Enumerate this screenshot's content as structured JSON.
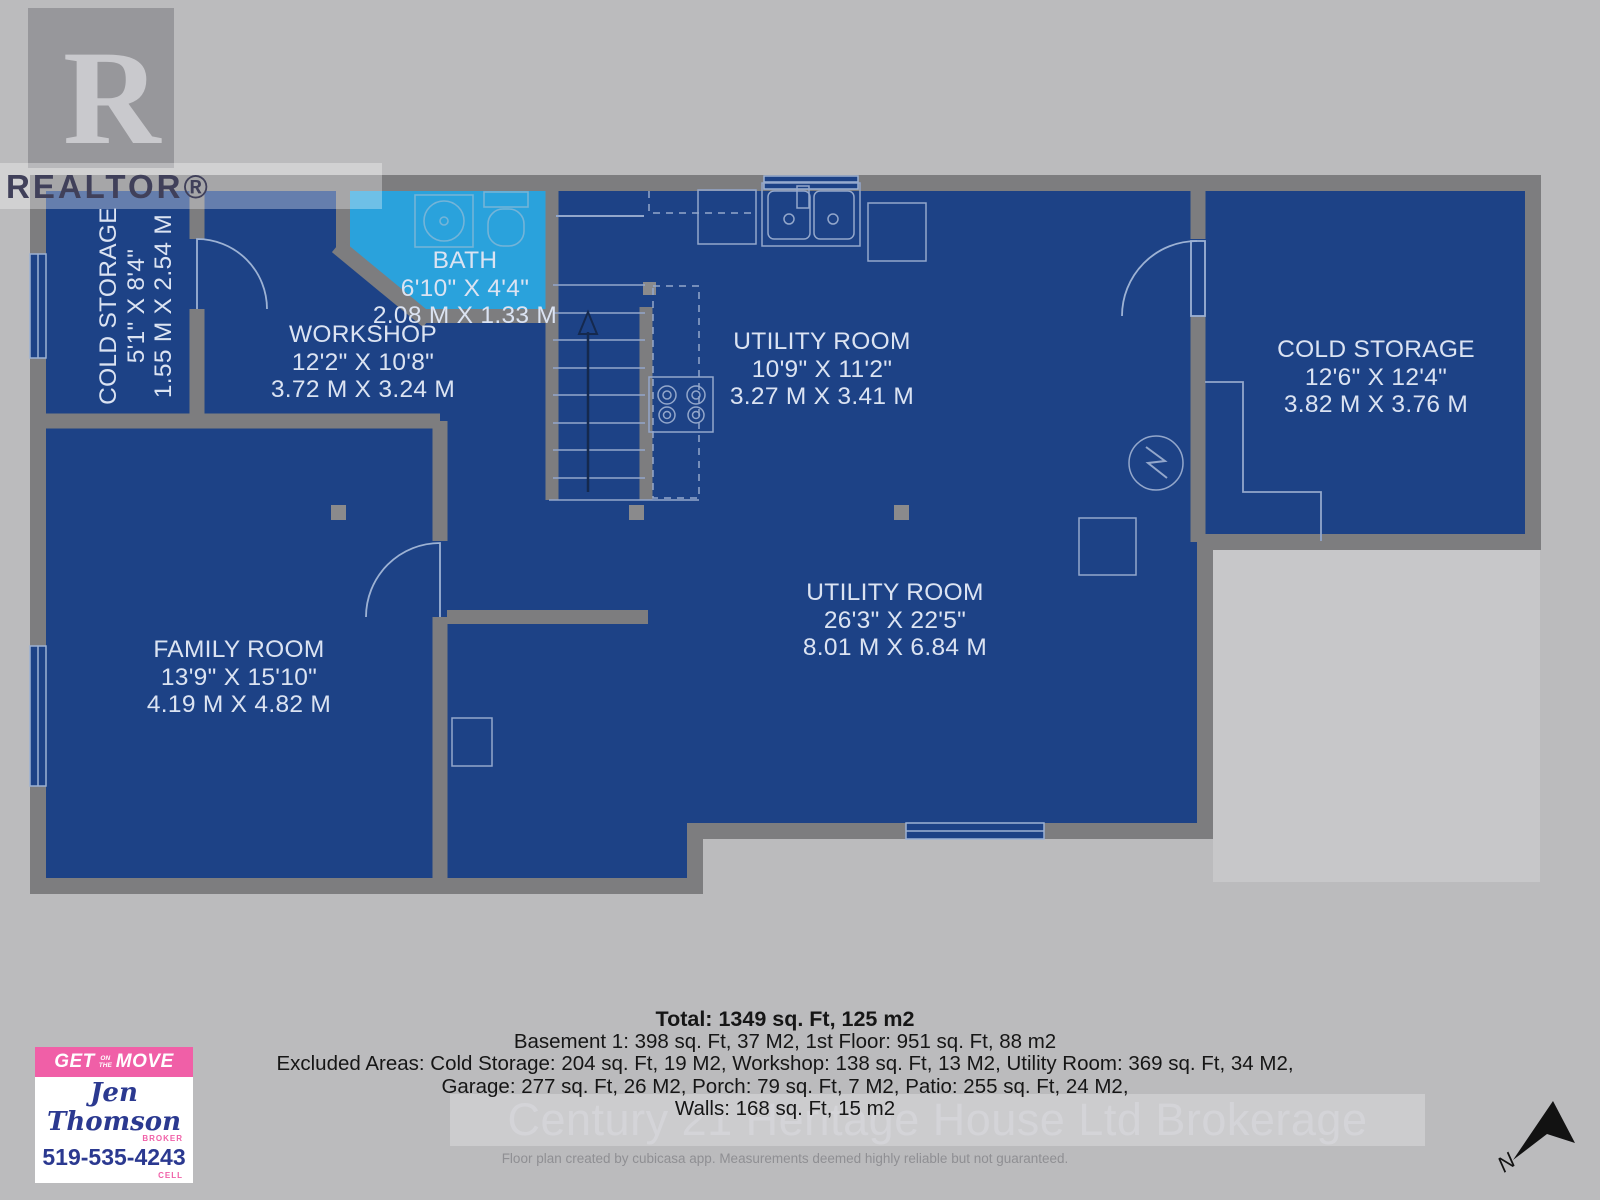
{
  "branding": {
    "realtor_text": "REALTOR®",
    "realtor_r": "R",
    "watermark": "Century 21 Heritage House Ltd Brokerage",
    "disclaimer": "Floor plan created by cubicasa app. Measurements deemed highly reliable but not guaranteed."
  },
  "agent_card": {
    "banner_get": "GET",
    "banner_on": "ON",
    "banner_the": "THE",
    "banner_move": "MOVE",
    "name": "Jen Thomson",
    "title": "BROKER",
    "phone": "519-535-4243",
    "phone_label": "CELL"
  },
  "compass": {
    "north_label": "N"
  },
  "summary": {
    "total": "Total: 1349 sq. Ft, 125 m2",
    "floors": "Basement 1: 398 sq. Ft, 37 M2, 1st Floor: 951 sq. Ft, 88 m2",
    "excluded_1": "Excluded Areas: Cold Storage: 204 sq. Ft, 19 M2, Workshop: 138 sq. Ft, 13 M2, Utility Room: 369 sq. Ft, 34 M2,",
    "excluded_2": "Garage: 277 sq. Ft, 26 M2, Porch: 79 sq. Ft, 7 M2, Patio: 255 sq. Ft, 24 M2,",
    "walls": "Walls: 168 sq. Ft, 15 m2"
  },
  "rooms": [
    {
      "name": "COLD STORAGE",
      "imperial": "5'1\" X 8'4\"",
      "metric": "1.55 M X 2.54 M"
    },
    {
      "name": "BATH",
      "imperial": "6'10\" X 4'4\"",
      "metric": "2.08 M X 1.33 M"
    },
    {
      "name": "WORKSHOP",
      "imperial": "12'2\" X 10'8\"",
      "metric": "3.72 M X 3.24 M"
    },
    {
      "name": "UTILITY ROOM",
      "imperial": "10'9\" X 11'2\"",
      "metric": "3.27 M X 3.41 M"
    },
    {
      "name": "COLD STORAGE",
      "imperial": "12'6\" X 12'4\"",
      "metric": "3.82 M X 3.76 M"
    },
    {
      "name": "UTILITY ROOM",
      "imperial": "26'3\" X 22'5\"",
      "metric": "8.01 M X 6.84 M"
    },
    {
      "name": "FAMILY ROOM",
      "imperial": "13'9\" X 15'10\"",
      "metric": "4.19 M X 4.82 M"
    }
  ],
  "colors": {
    "floor_blue": "#1d4286",
    "bath_blue": "#2aa2dc",
    "wall_gray": "#7d7d7f",
    "background": "#bbbbbd",
    "accent_pink": "#f05fa7",
    "accent_navy": "#2b3990"
  }
}
